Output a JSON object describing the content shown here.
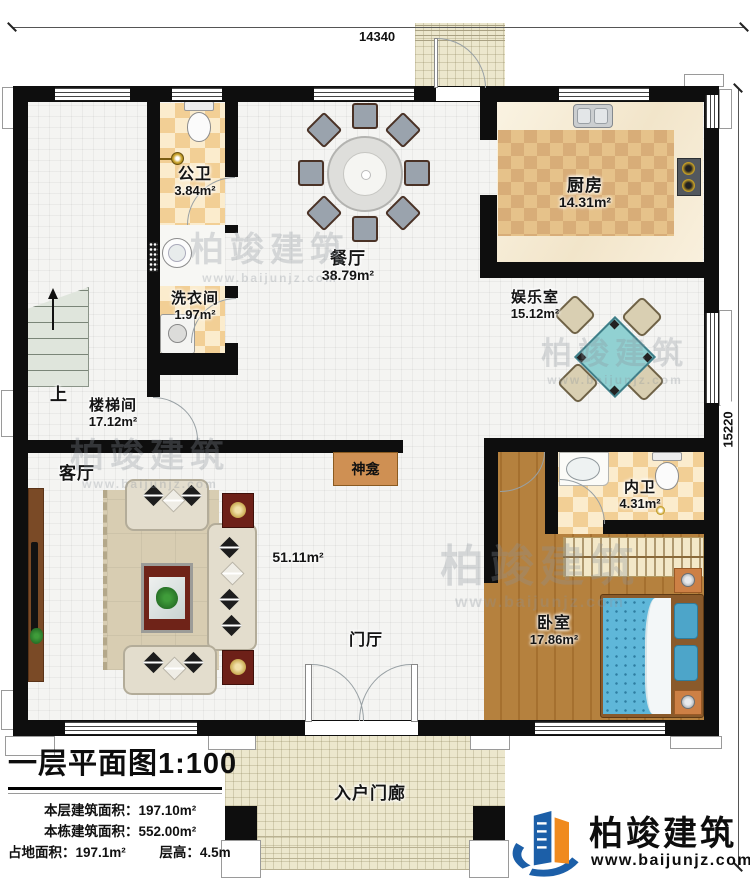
{
  "dims": {
    "width": "14340",
    "height": "15220"
  },
  "rooms": [
    {
      "id": "gongwei",
      "name": "公卫",
      "area": "3.84m²"
    },
    {
      "id": "xiyijian",
      "name": "洗衣间",
      "area": "1.97m²"
    },
    {
      "id": "canting",
      "name": "餐厅",
      "area": "38.79m²"
    },
    {
      "id": "chufang",
      "name": "厨房",
      "area": "14.31m²"
    },
    {
      "id": "yuleshi",
      "name": "娱乐室",
      "area": "15.12m²"
    },
    {
      "id": "loutijian",
      "name": "楼梯间",
      "area": "17.12m²"
    },
    {
      "id": "keting",
      "name": "客厅",
      "area": "51.11m²"
    },
    {
      "id": "neiwei",
      "name": "内卫",
      "area": "4.31m²"
    },
    {
      "id": "woshi",
      "name": "卧室",
      "area": "17.86m²"
    },
    {
      "id": "menting",
      "name": "门厅",
      "area": ""
    },
    {
      "id": "rumenlang",
      "name": "入户门廊",
      "area": ""
    }
  ],
  "labels": {
    "up": "上",
    "shrine": "神龛"
  },
  "title_block": {
    "title": "一层平面图",
    "scale": "1:100",
    "stats": [
      {
        "label": "本层建筑面积：",
        "value": "197.10m²"
      },
      {
        "label": "本栋建筑面积：",
        "value": "552.00m²"
      },
      {
        "label": "占地面积：",
        "value": "197.1m²"
      },
      {
        "label": "层高：",
        "value": "4.5m"
      }
    ]
  },
  "branding": {
    "company": "柏竣建筑",
    "website": "www.baijunjz.com",
    "blue": "#1c5fa8",
    "orange": "#f08a1e"
  },
  "watermark": {
    "company": "柏竣建筑",
    "website": "www.baijunjz.com"
  }
}
